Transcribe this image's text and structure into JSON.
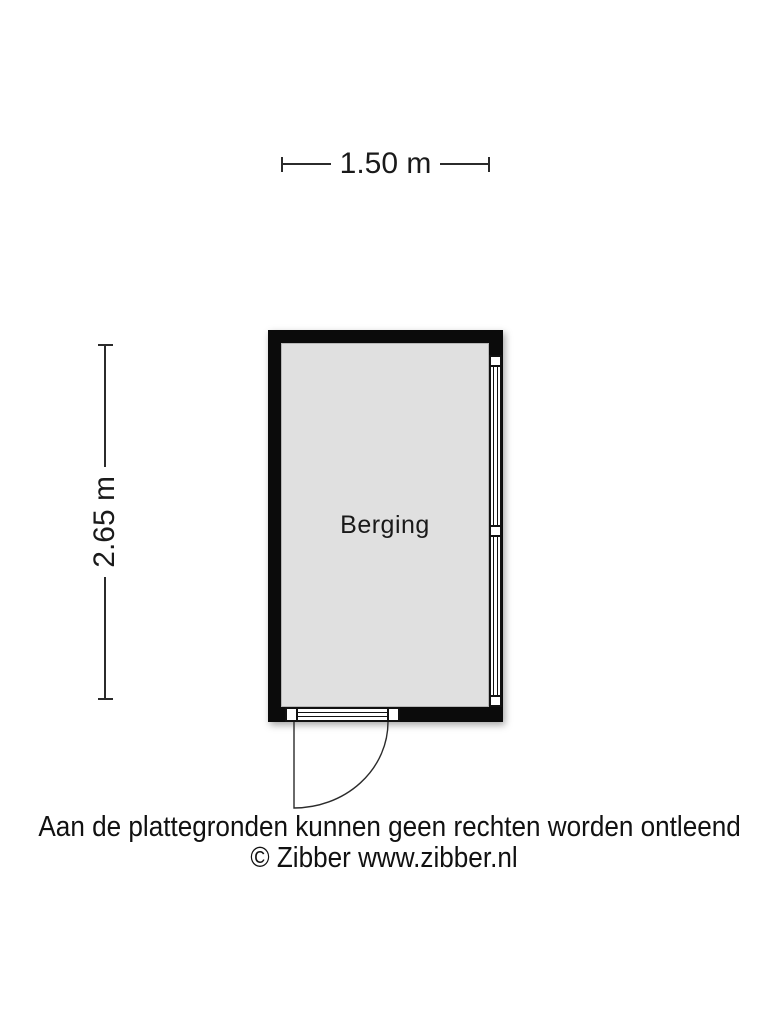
{
  "floorplan": {
    "room_label": "Berging",
    "dim_width_label": "1.50 m",
    "dim_height_label": "2.65 m"
  },
  "footer": {
    "disclaimer": "Aan de plattegronden kunnen geen rechten worden ontleend",
    "copyright": "© Zibber www.zibber.nl"
  },
  "colors": {
    "wall": "#0b0b0b",
    "floor": "#e0e0e0",
    "dimension_line": "#2b2b2b",
    "text": "#1a1a1a",
    "background": "#ffffff"
  }
}
